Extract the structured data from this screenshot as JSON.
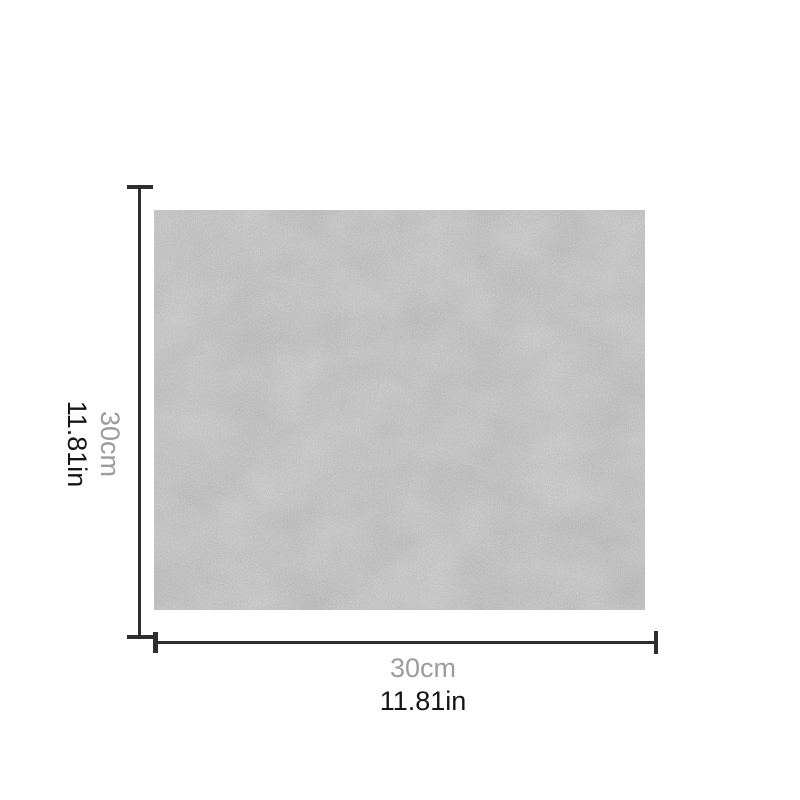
{
  "page": {
    "background": "#ffffff"
  },
  "diagram": {
    "kind": "product-dimension-diagram",
    "swatch": {
      "description": "gray-felt-fabric-swatch",
      "base_color": "#8f8f8f"
    },
    "line_color": "#2e2e2e",
    "metric_color": "#9c9c9c",
    "imperial_color": "#151515",
    "height_label": {
      "metric": "30cm",
      "imperial": "11.81in"
    },
    "width_label": {
      "metric": "30cm",
      "imperial": "11.81in"
    }
  }
}
